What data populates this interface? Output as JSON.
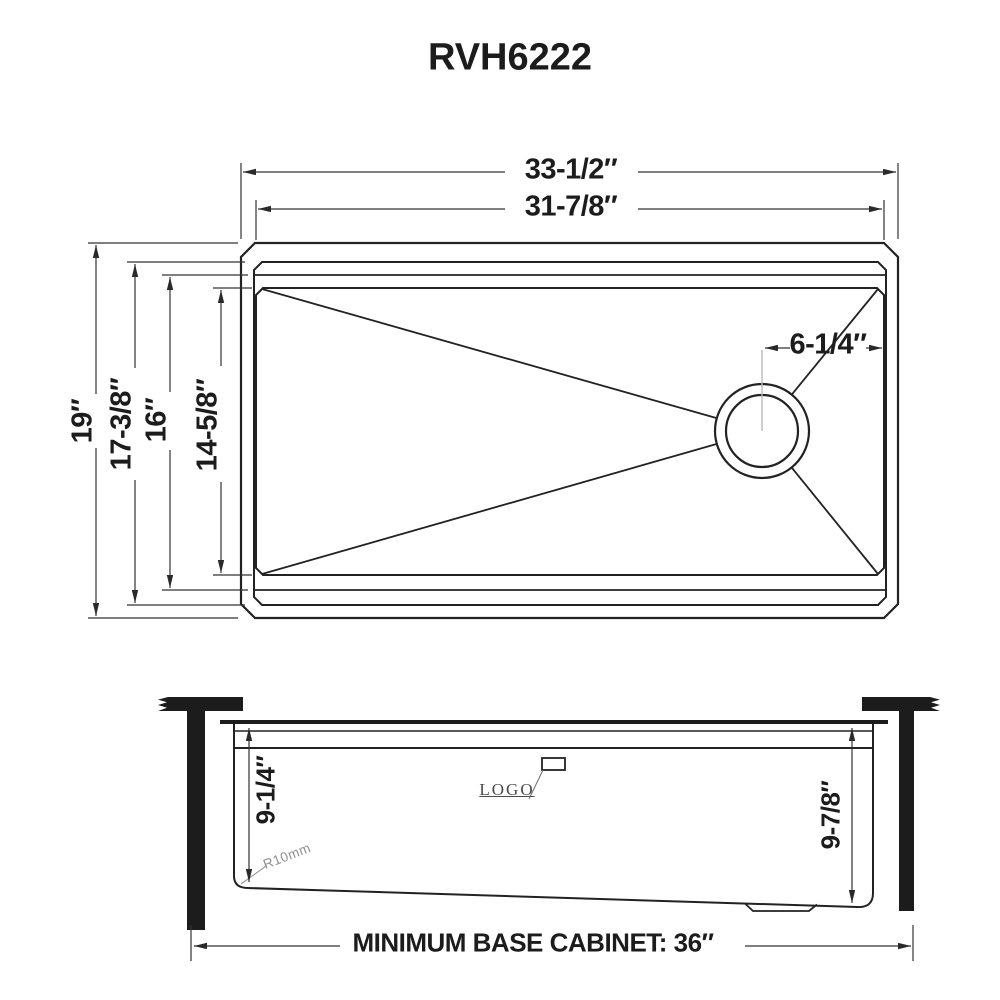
{
  "title": "RVH6222",
  "top_view": {
    "outer_width": "33-1/2″",
    "inner_width": "31-7/8″",
    "outer_depth": "19″",
    "rim_depth": "17-3/8″",
    "ledge_depth": "16″",
    "bowl_depth": "14-5/8″",
    "drain_offset": "6-1/4″"
  },
  "side_view": {
    "bowl_depth_left": "9-1/4″",
    "bowl_depth_right": "9-7/8″",
    "corner_radius": "R10mm",
    "logo": "LOGO",
    "base_cabinet_note": "MINIMUM BASE CABINET: 36″"
  },
  "colors": {
    "line": "#222222",
    "dim_line": "#3a3a3a",
    "annotation_gray": "#8f8f8f",
    "background": "#ffffff"
  }
}
